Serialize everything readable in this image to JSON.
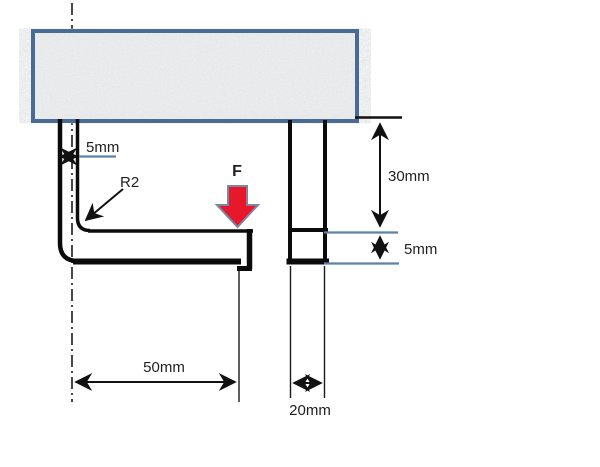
{
  "diagram": {
    "title": "L-bracket under ceiling support - dimensioned drawing",
    "views": {
      "front_view": "L-shaped bracket fixed to support block",
      "side_view": "cross-section of bracket arm"
    },
    "labels": {
      "thickness_front": "5mm",
      "fillet_radius": "R2",
      "force": "F",
      "arm_length": "50mm",
      "upper_height": "30mm",
      "arm_thickness_side": "5mm",
      "section_width": "20mm"
    },
    "colors": {
      "support_border": "#4a6b94",
      "dimension_blue": "#5e81ab",
      "force_fill": "#e8182c",
      "force_outline": "#7b87a1",
      "line_black": "#111111"
    }
  }
}
